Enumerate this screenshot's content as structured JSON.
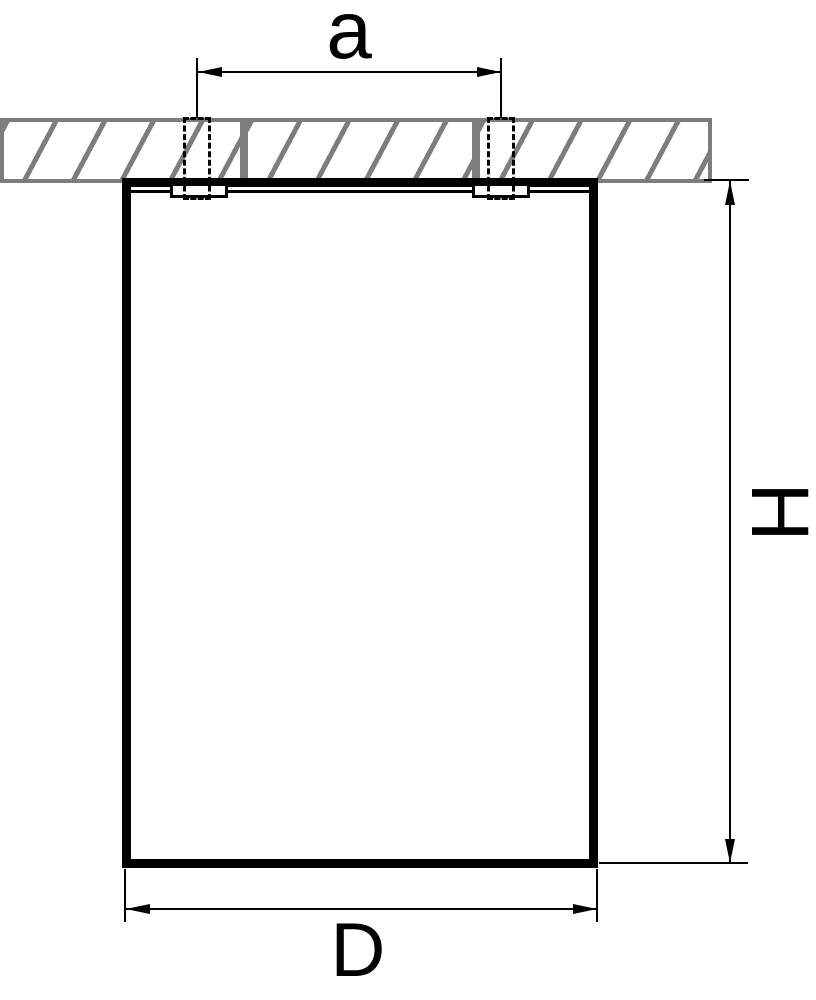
{
  "drawing": {
    "kind": "fixture-dimension-diagram",
    "labels": {
      "hole_spacing": "a",
      "height": "H",
      "diameter": "D"
    },
    "colors": {
      "line": "#000000",
      "ceiling_gray": "#7d7d7d",
      "background": "#ffffff"
    }
  }
}
